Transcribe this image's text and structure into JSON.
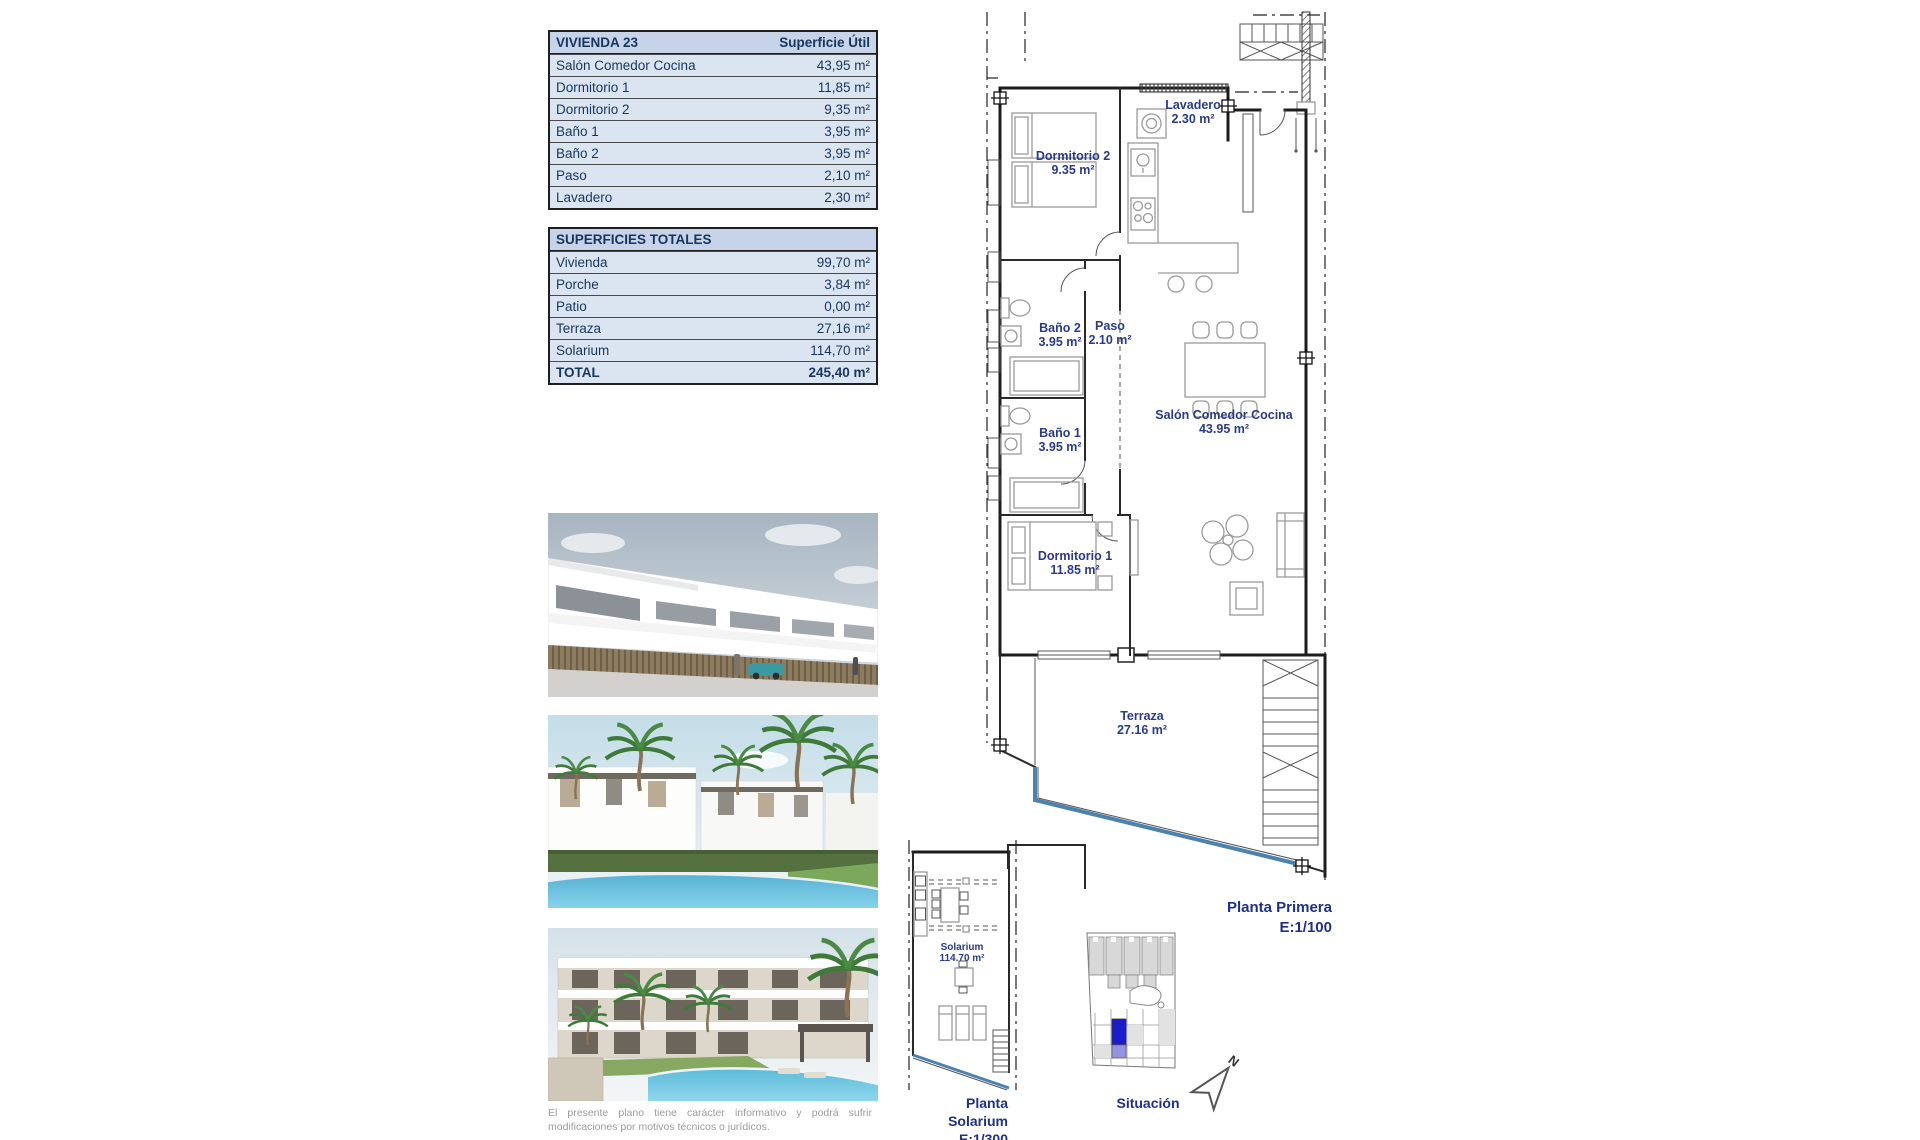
{
  "unit_table": {
    "title": "VIVIENDA 23",
    "header_value": "Superficie Útil",
    "rows": [
      {
        "label": "Salón Comedor Cocina",
        "value": "43,95 m²"
      },
      {
        "label": "Dormitorio 1",
        "value": "11,85 m²"
      },
      {
        "label": "Dormitorio 2",
        "value": "9,35 m²"
      },
      {
        "label": "Baño 1",
        "value": "3,95 m²"
      },
      {
        "label": "Baño 2",
        "value": "3,95 m²"
      },
      {
        "label": "Paso",
        "value": "2,10 m²"
      },
      {
        "label": "Lavadero",
        "value": "2,30 m²"
      }
    ]
  },
  "totals_table": {
    "title": "SUPERFICIES TOTALES",
    "rows": [
      {
        "label": "Vivienda",
        "value": "99,70 m²"
      },
      {
        "label": "Porche",
        "value": "3,84 m²"
      },
      {
        "label": "Patio",
        "value": "0,00 m²"
      },
      {
        "label": "Terraza",
        "value": "27,16 m²"
      },
      {
        "label": "Solarium",
        "value": "114,70 m²"
      }
    ],
    "total_row": {
      "label": "TOTAL",
      "value": "245,40 m²"
    }
  },
  "floor_plan": {
    "caption": "Planta Primera",
    "scale": "E:1/100",
    "rooms": [
      {
        "name": "Dormitorio 2",
        "area": "9.35 m²"
      },
      {
        "name": "Lavadero",
        "area": "2.30 m²"
      },
      {
        "name": "Baño 2",
        "area": "3.95 m²"
      },
      {
        "name": "Paso",
        "area": "2.10 m²"
      },
      {
        "name": "Baño 1",
        "area": "3.95 m²"
      },
      {
        "name": "Salón Comedor Cocina",
        "area": "43.95 m²"
      },
      {
        "name": "Dormitorio 1",
        "area": "11.85 m²"
      },
      {
        "name": "Terraza",
        "area": "27.16 m²"
      }
    ]
  },
  "solarium_plan": {
    "caption": "Planta Solarium",
    "scale": "E:1/300",
    "room": {
      "name": "Solarium",
      "area": "114.70 m²"
    }
  },
  "situation_map": {
    "caption": "Situación",
    "north_label": "N",
    "highlight_color": "#1c1ccc"
  },
  "disclaimer": "El presente plano tiene carácter informativo y podrá sufrir modificaciones por motivos técnicos o jurídicos.",
  "colors": {
    "table_header_bg": "#c6d3e8",
    "table_row_bg": "#dbe5f1",
    "table_text": "#17365d",
    "plan_label": "#2b3a8c",
    "glass_line": "#4a82b0"
  }
}
